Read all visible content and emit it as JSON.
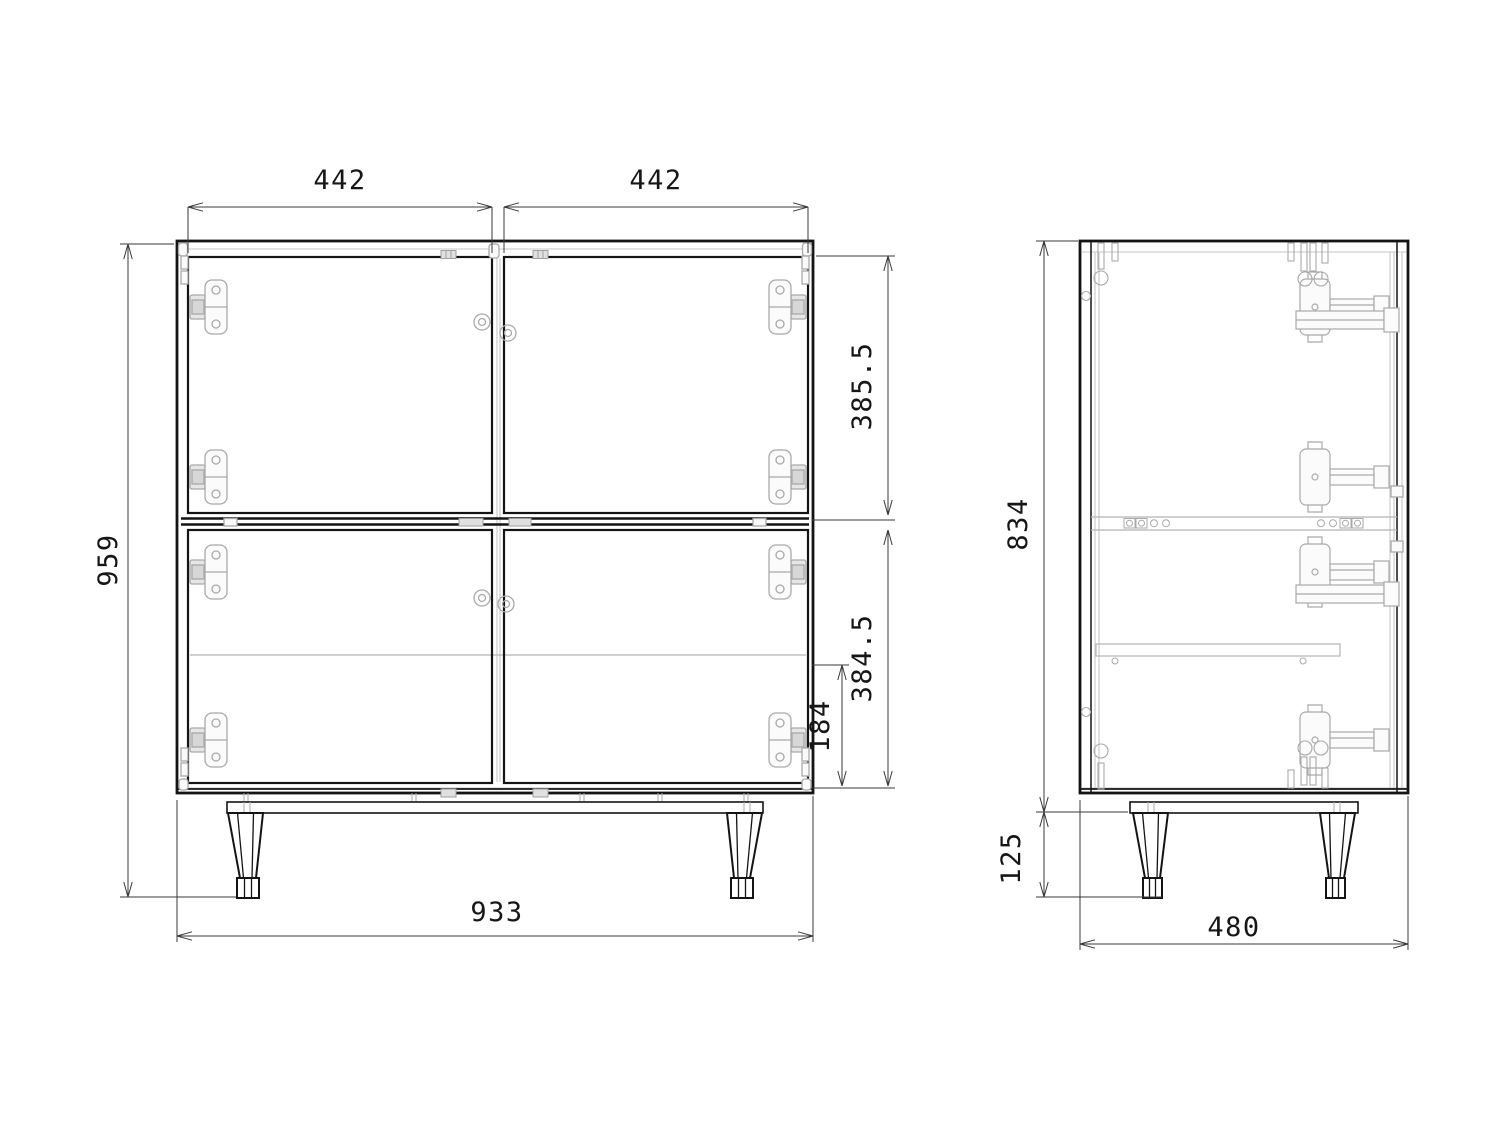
{
  "title": "Cabinet technical drawing - front and side orthographic views",
  "colors": {
    "background": "#ffffff",
    "outline": "#141414",
    "hardware": "#a9a9a9",
    "dimension_lines": "#3a3a3a",
    "dimension_text": "#161616"
  },
  "front_view": {
    "name": "front-view",
    "dimensions": {
      "door_width_left": "442",
      "door_width_right": "442",
      "overall_height": "959",
      "top_section_height": "385.5",
      "bottom_section_height": "384.5",
      "shelf_to_bottom": "184",
      "overall_width": "933"
    }
  },
  "side_view": {
    "name": "side-view",
    "dimensions": {
      "body_height": "834",
      "leg_height": "125",
      "depth": "480"
    }
  }
}
